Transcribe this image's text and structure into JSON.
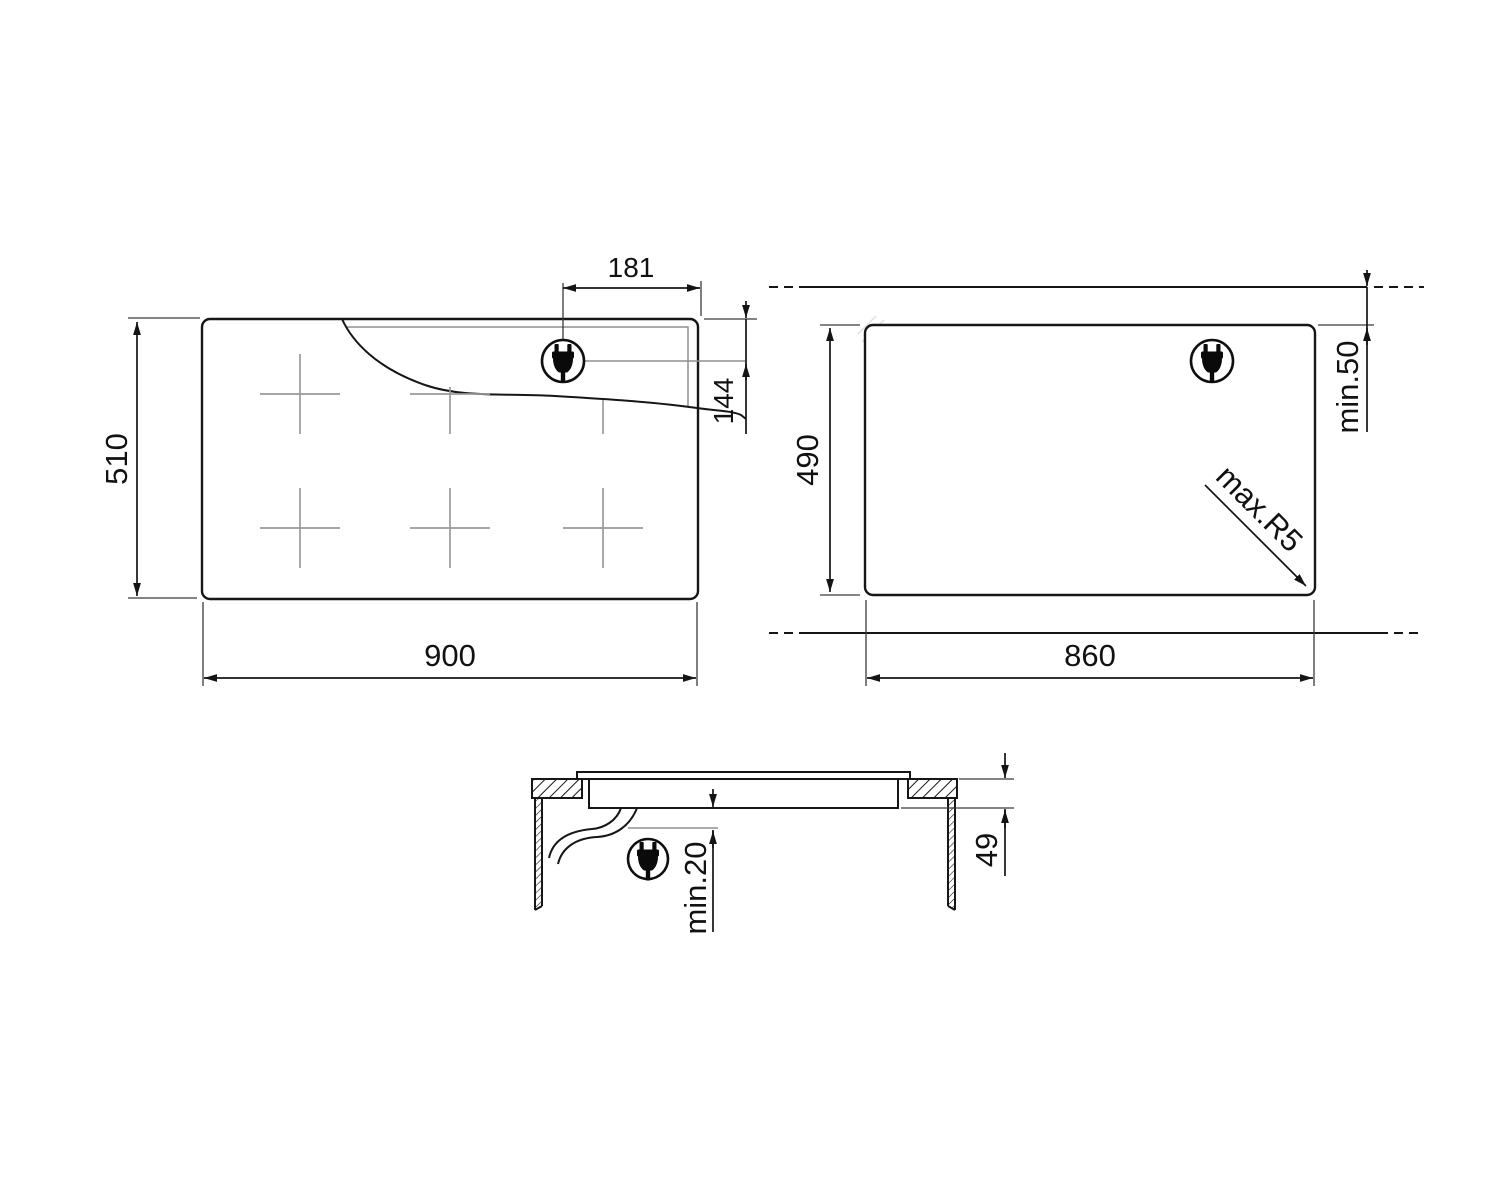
{
  "drawing": {
    "background": "#ffffff",
    "line_color": "#161616",
    "dimension_color": "#141414",
    "light_gray": "#9a9a9a"
  },
  "views": {
    "plan": {
      "dims": {
        "width": "900",
        "depth": "510",
        "plug_from_right": "181",
        "plug_from_top": "144"
      }
    },
    "cutout": {
      "dims": {
        "width": "860",
        "depth": "490",
        "min_front": "min.50",
        "max_corner_radius": "max.R5"
      }
    },
    "section": {
      "dims": {
        "min_clearance_below": "min.20",
        "built_in_depth": "49"
      }
    }
  },
  "icons": {
    "power_plug": "power-plug-icon"
  }
}
